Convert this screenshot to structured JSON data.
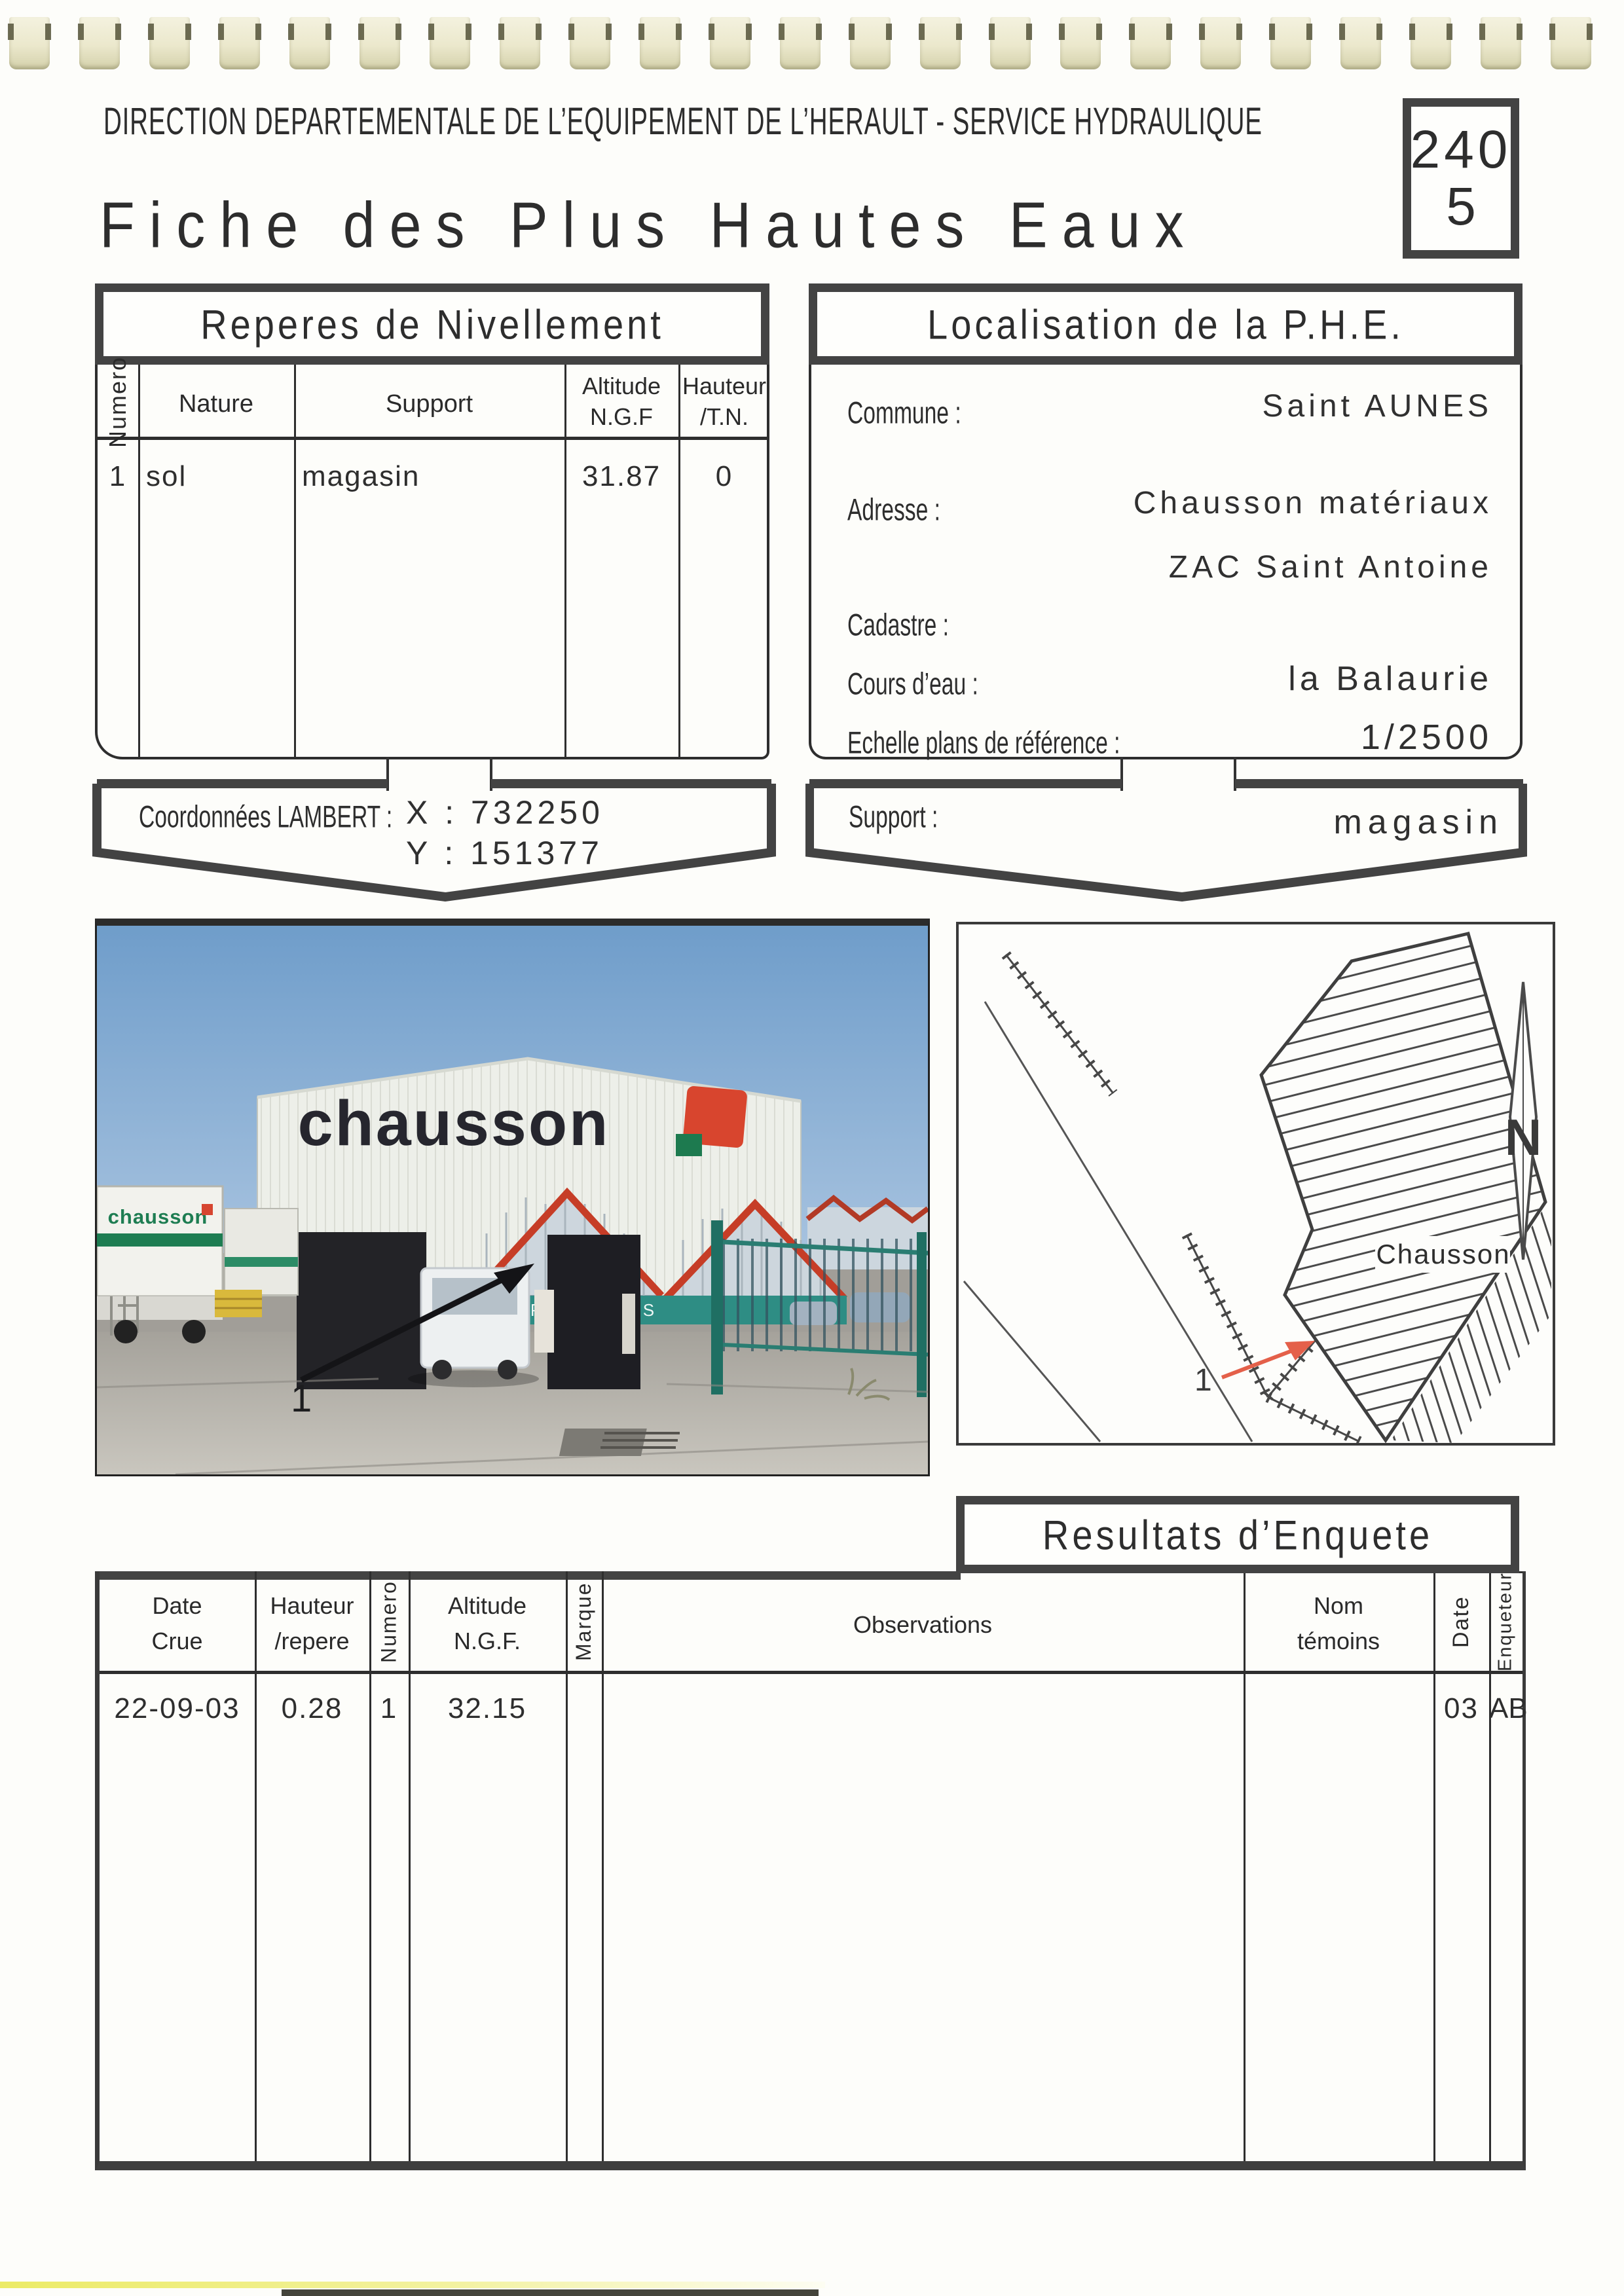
{
  "header": {
    "line": "DIRECTION DEPARTEMENTALE DE L’EQUIPEMENT DE L’HERAULT - SERVICE HYDRAULIQUE"
  },
  "doc_box": {
    "line1": "240",
    "line2": "5"
  },
  "title": "Fiche des Plus Hautes Eaux",
  "reperes": {
    "title": "Reperes de Nivellement",
    "columns": {
      "numero": "Numero",
      "nature": "Nature",
      "support": "Support",
      "altitude_l1": "Altitude",
      "altitude_l2": "N.G.F",
      "hauteur_l1": "Hauteur",
      "hauteur_l2": "/T.N."
    },
    "row": {
      "numero": "1",
      "nature": "sol",
      "support": "magasin",
      "altitude": "31.87",
      "hauteur": "0"
    }
  },
  "lambert": {
    "label": "Coordonnées LAMBERT :",
    "x": "X : 732250",
    "y": "Y : 151377"
  },
  "localisation": {
    "title": "Localisation de la P.H.E.",
    "commune_label": "Commune :",
    "commune": "Saint AUNES",
    "adresse_label": "Adresse :",
    "adresse1": "Chausson matériaux",
    "adresse2": "ZAC Saint Antoine",
    "cadastre_label": "Cadastre :",
    "cadastre": "",
    "cours_label": "Cours d’eau :",
    "cours": "la Balaurie",
    "echelle_label": "Echelle plans de référence :",
    "echelle": "1/2500"
  },
  "support_banner": {
    "label": "Support :",
    "value": "magasin"
  },
  "photo": {
    "building_sign": "chausson",
    "truck_sign": "chausson",
    "strip_sign": "PLAFONDS",
    "marker": "1"
  },
  "map": {
    "building_label": "Chausson",
    "marker": "1",
    "compass_letter": "N"
  },
  "resultats": {
    "title": "Resultats d’Enquete",
    "columns": {
      "date_l1": "Date",
      "date_l2": "Crue",
      "hauteur_l1": "Hauteur",
      "hauteur_l2": "/repere",
      "numero": "Numero",
      "altitude_l1": "Altitude",
      "altitude_l2": "N.G.F.",
      "marque": "Marque",
      "observations": "Observations",
      "nom_l1": "Nom",
      "nom_l2": "témoins",
      "date2": "Date",
      "enqueteur": "Enqueteur"
    },
    "row": {
      "date_crue": "22-09-03",
      "hauteur": "0.28",
      "numero": "1",
      "altitude": "32.15",
      "marque": "",
      "observations": "",
      "nom": "",
      "date": "03",
      "enqueteur": "AB"
    }
  }
}
